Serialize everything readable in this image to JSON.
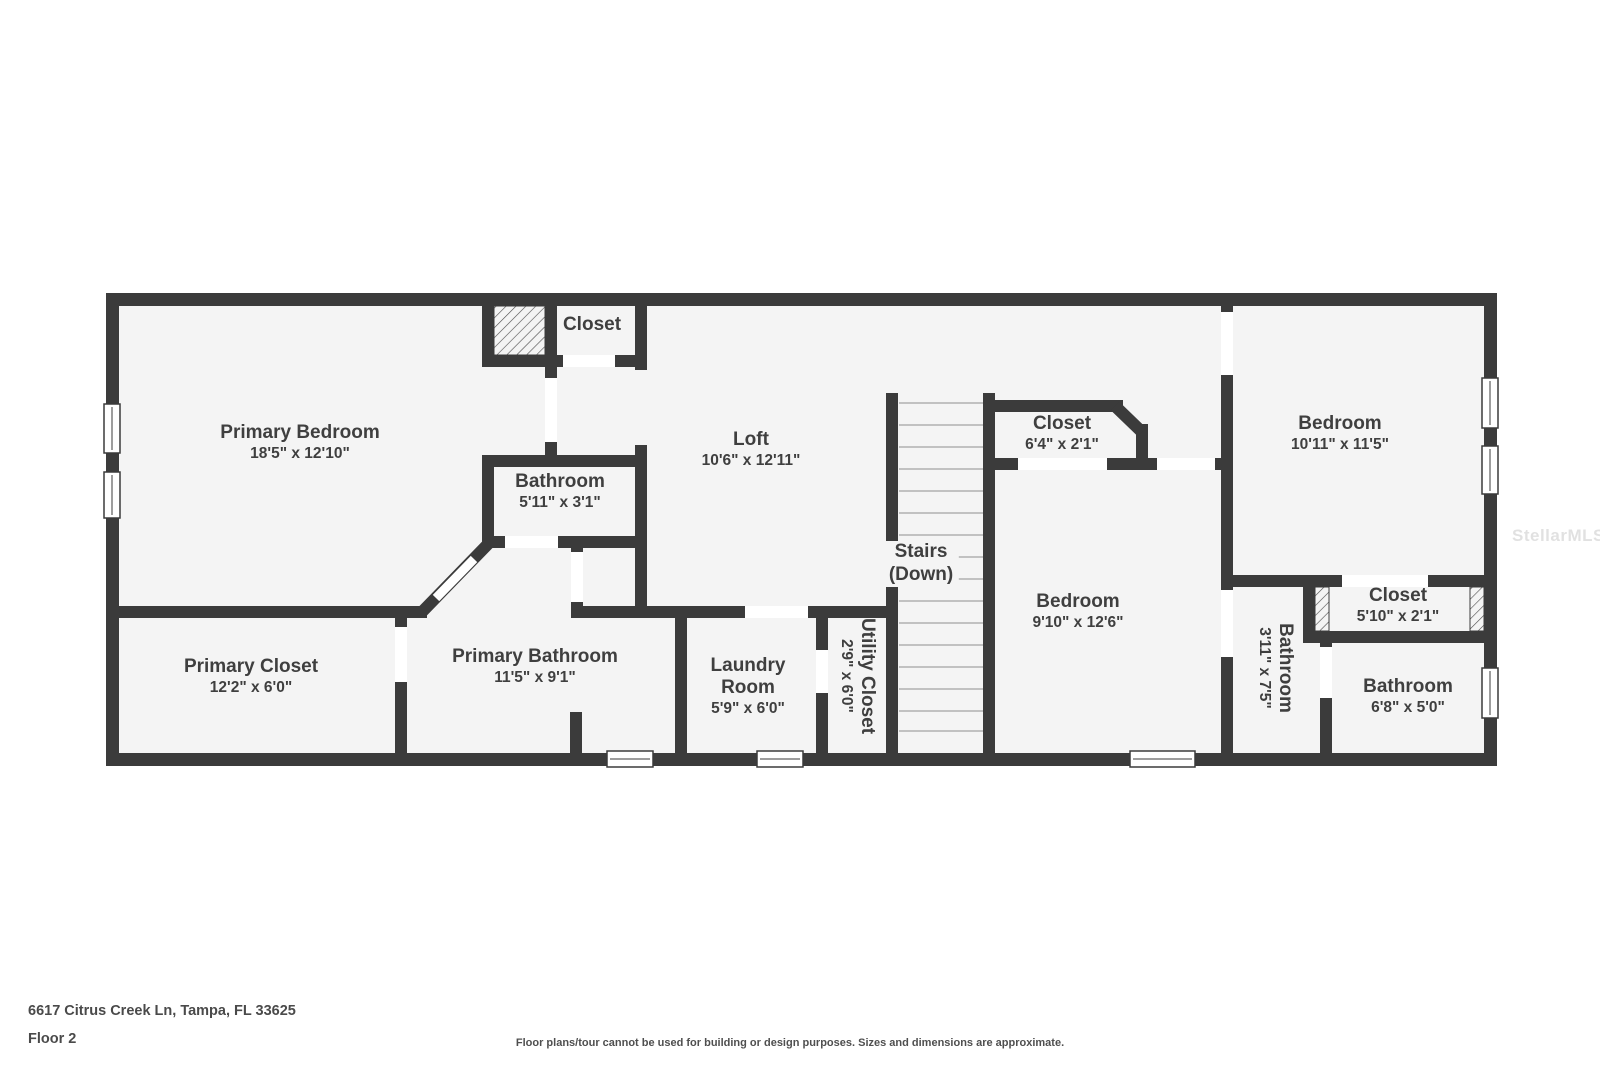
{
  "rooms": [
    {
      "id": "primary-bedroom",
      "name": "Primary Bedroom",
      "dims": "18'5\" x 12'10\""
    },
    {
      "id": "closet-top",
      "name": "Closet",
      "dims": ""
    },
    {
      "id": "bathroom-wc",
      "name": "Bathroom",
      "dims": "5'11\" x 3'1\""
    },
    {
      "id": "loft",
      "name": "Loft",
      "dims": "10'6\" x 12'11\""
    },
    {
      "id": "stairs",
      "name": "Stairs",
      "dims": "(Down)"
    },
    {
      "id": "closet-64",
      "name": "Closet",
      "dims": "6'4\" x 2'1\""
    },
    {
      "id": "bedroom-910",
      "name": "Bedroom",
      "dims": "9'10\" x 12'6\""
    },
    {
      "id": "bedroom-1011",
      "name": "Bedroom",
      "dims": "10'11\" x 11'5\""
    },
    {
      "id": "primary-closet",
      "name": "Primary Closet",
      "dims": "12'2\" x 6'0\""
    },
    {
      "id": "primary-bathroom",
      "name": "Primary Bathroom",
      "dims": "11'5\" x 9'1\""
    },
    {
      "id": "laundry-room",
      "name": "Laundry Room",
      "dims": "5'9\" x 6'0\""
    },
    {
      "id": "utility-closet",
      "name": "Utility Closet",
      "dims": "2'9\" x 6'0\""
    },
    {
      "id": "bathroom-311",
      "name": "Bathroom",
      "dims": "3'11\" x 7'5\""
    },
    {
      "id": "closet-510",
      "name": "Closet",
      "dims": "5'10\" x 2'1\""
    },
    {
      "id": "bathroom-68",
      "name": "Bathroom",
      "dims": "6'8\" x 5'0\""
    }
  ],
  "footer": {
    "address": "6617 Citrus Creek Ln, Tampa, FL 33625",
    "floor_label": "Floor 2",
    "disclaimer": "Floor plans/tour cannot be used for building or design purposes. Sizes and dimensions are approximate."
  },
  "watermark": "StellarMLS",
  "colors": {
    "wall": "#3b3b3b",
    "room_fill": "#f4f4f4",
    "text": "#3f3f3f",
    "background": "#ffffff",
    "stair_tread": "#b0b0b0"
  }
}
